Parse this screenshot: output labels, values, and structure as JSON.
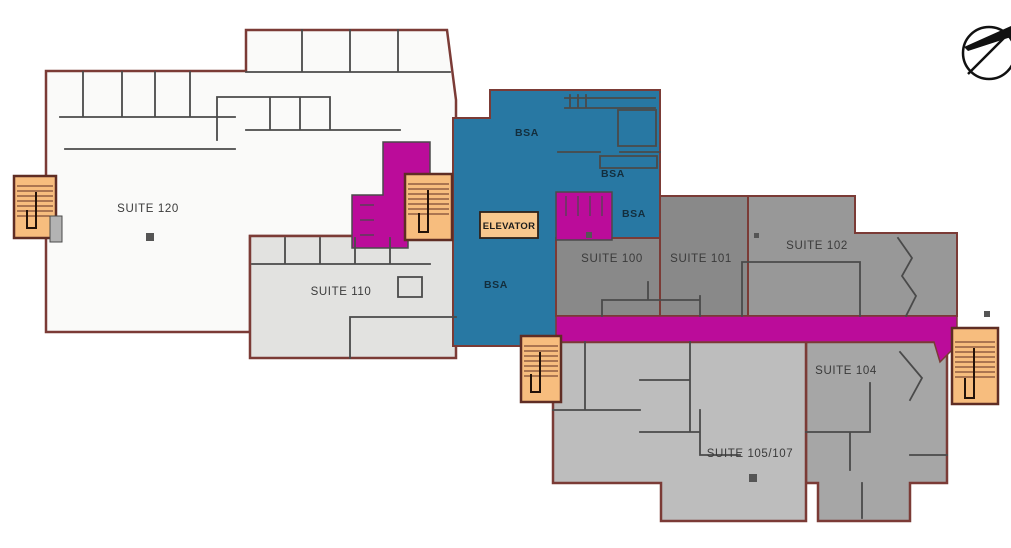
{
  "colors": {
    "background": "#ffffff",
    "outline": "#7b3b36",
    "wall": "#4a4a4a",
    "suite_120_fill": "#fafaf9",
    "suite_110_fill": "#e2e2e0",
    "bsa_fill": "#2878a3",
    "circulation_magenta": "#bb0c9a",
    "suite_100_101_fill": "#898989",
    "suite_102_fill": "#989898",
    "suite_104_fill": "#a6a6a6",
    "suite_105_107_fill": "#bdbdbd",
    "stair_fill": "#f7bd7e",
    "stair_outline": "#5f2d24",
    "elevator_fill": "#f8c88e",
    "label_color": "#3a3a3a",
    "column_color": "#555555"
  },
  "labels": {
    "suite_120": "SUITE 120",
    "suite_110": "SUITE 110",
    "suite_100": "SUITE 100",
    "suite_101": "SUITE 101",
    "suite_102": "SUITE 102",
    "suite_104": "SUITE 104",
    "suite_105_107": "SUITE 105/107",
    "bsa": "BSA",
    "elevator": "ELEVATOR"
  },
  "icons": {
    "north_arrow": "north-arrow"
  }
}
